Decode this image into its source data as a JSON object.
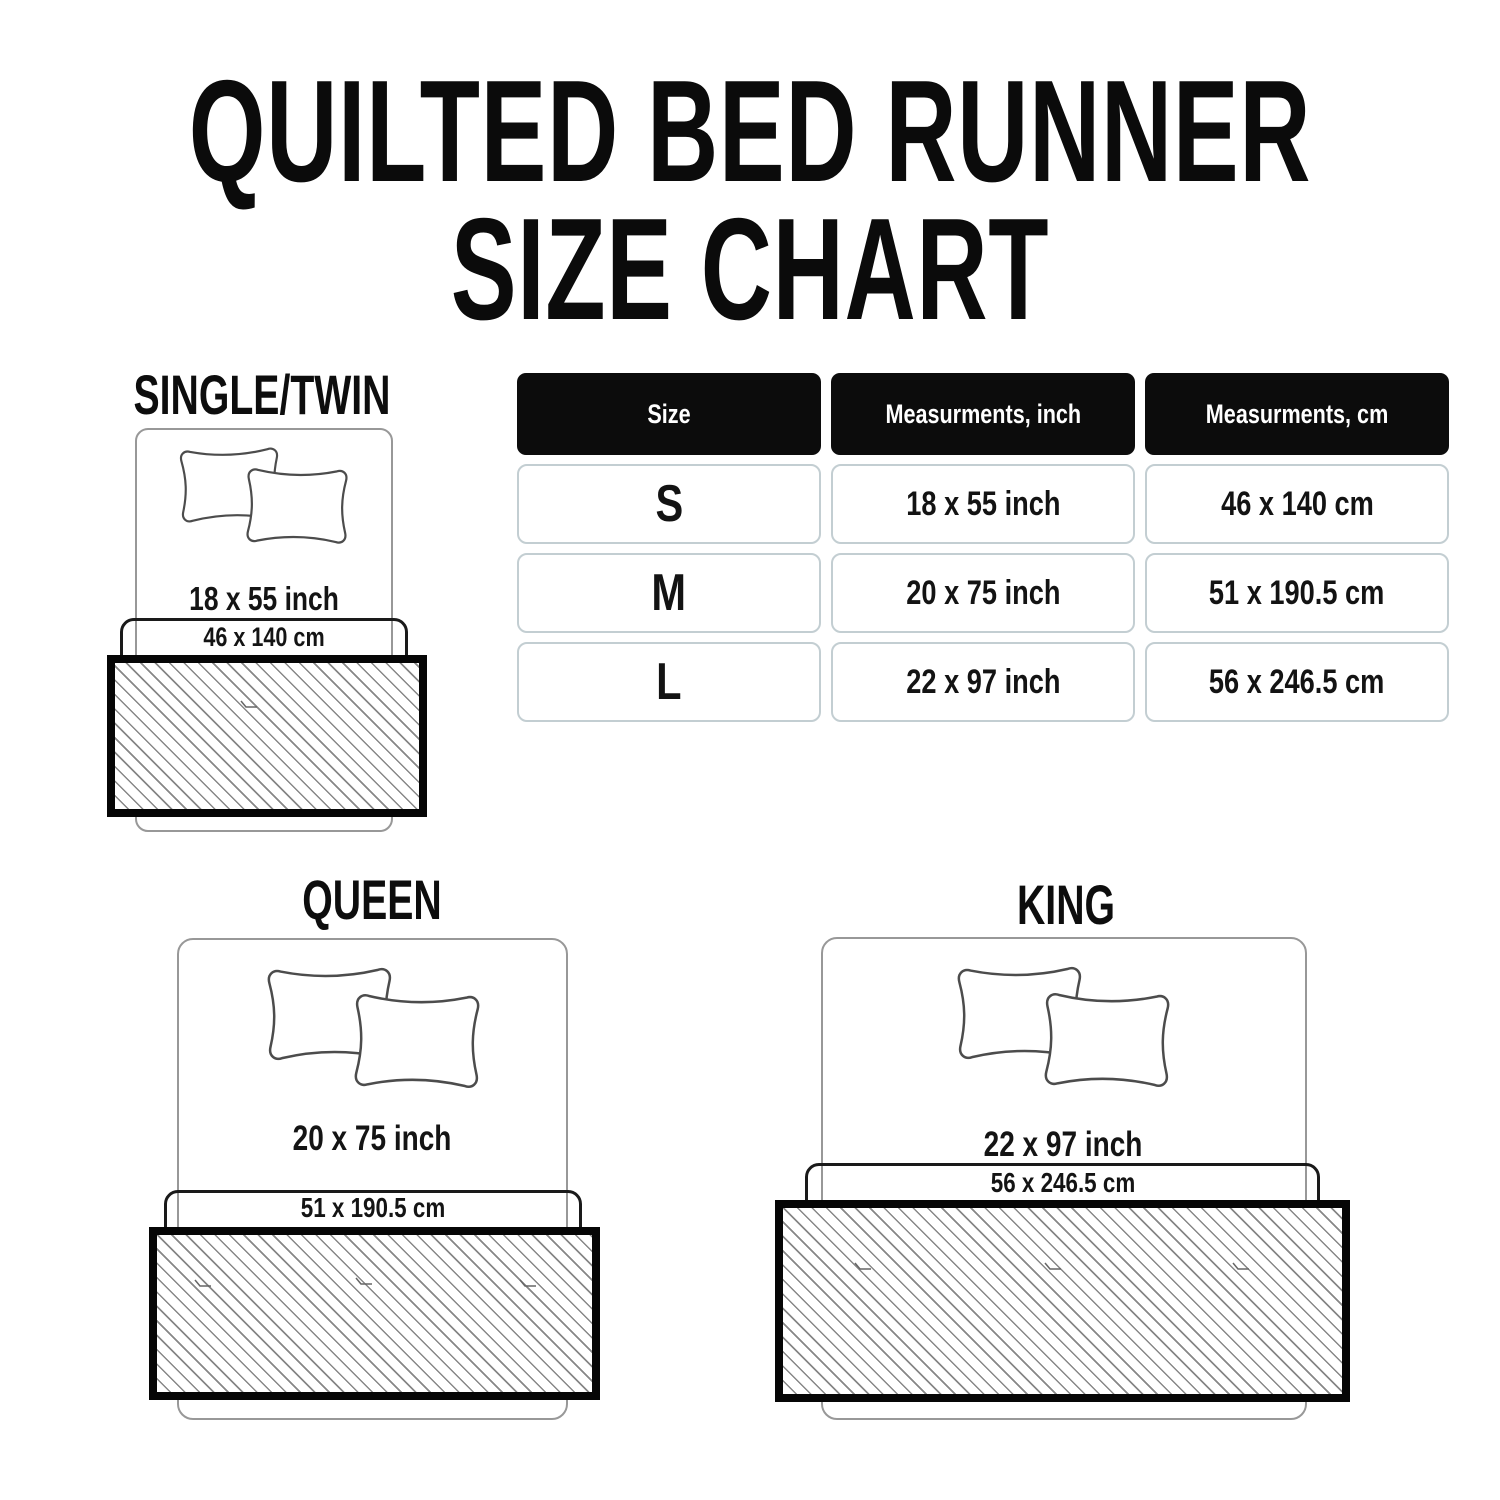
{
  "title": {
    "line1": "QUILTED BED RUNNER",
    "line2": "SIZE CHART"
  },
  "table": {
    "headers": [
      "Size",
      "Measurments, inch",
      "Measurments, cm"
    ],
    "rows": [
      {
        "size": "S",
        "inch": "18 x 55 inch",
        "cm": "46 x 140 cm"
      },
      {
        "size": "M",
        "inch": "20 x 75 inch",
        "cm": "51 x 190.5 cm"
      },
      {
        "size": "L",
        "inch": "22 x 97 inch",
        "cm": "56 x 246.5 cm"
      }
    ]
  },
  "diagrams": {
    "single": {
      "name": "SINGLE/TWIN",
      "inch": "18 x 55 inch",
      "cm": "46 x 140 cm"
    },
    "queen": {
      "name": "QUEEN",
      "inch": "20 x 75 inch",
      "cm": "51 x 190.5 cm"
    },
    "king": {
      "name": "KING",
      "inch": "22 x 97 inch",
      "cm": "56 x 246.5 cm"
    }
  },
  "colors": {
    "text": "#131313",
    "table_header_bg": "#0c0c0c",
    "table_header_text": "#ffffff",
    "table_cell_border": "#c3ced2",
    "bed_outline": "#989898",
    "pillow_outline": "#4c4c4c",
    "runner_border": "#060606",
    "hatch_line": "#878787"
  }
}
